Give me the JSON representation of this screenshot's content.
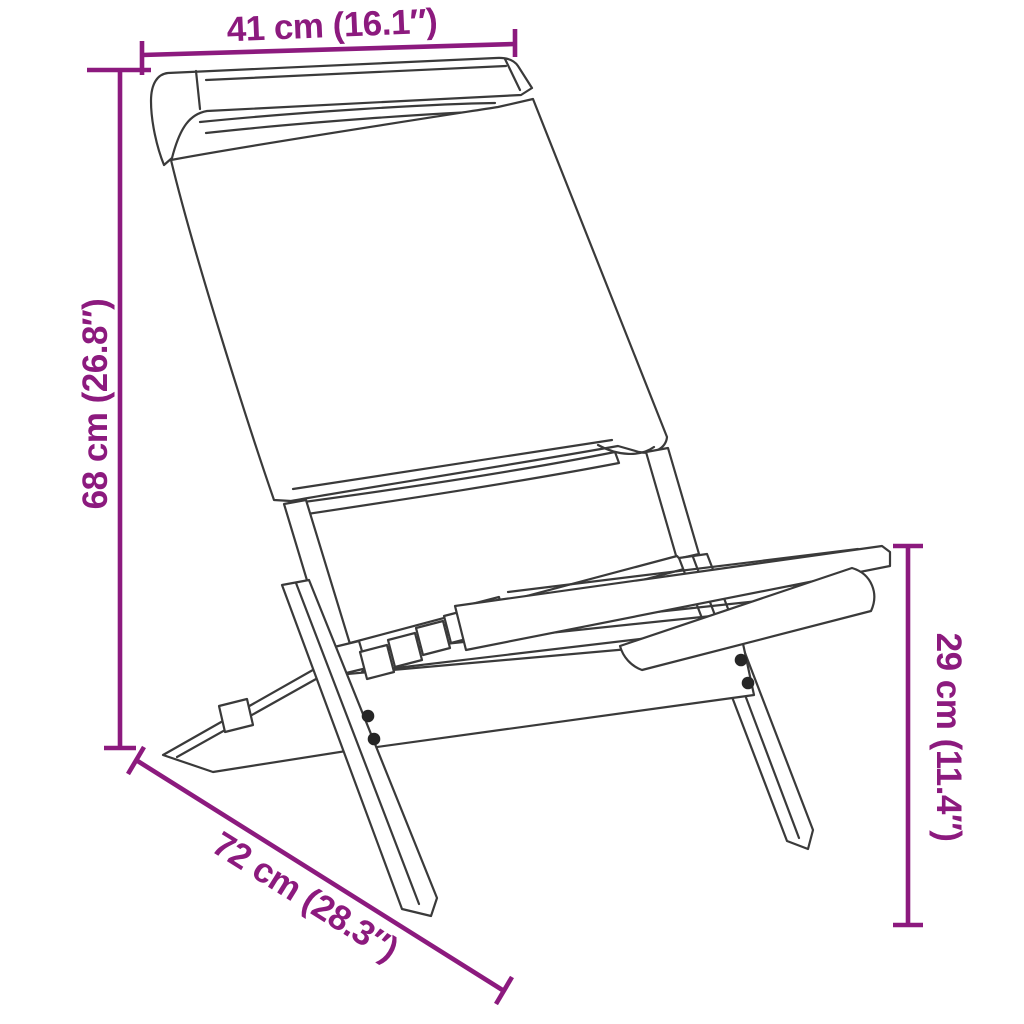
{
  "diagram": {
    "type": "product-dimension-diagram",
    "subject": "folding chair with fabric back and slatted wooden seat (line drawing)",
    "colors": {
      "dimension_accent": "#8C1A7E",
      "line_art": "#3A3A3A",
      "background": "#FFFFFF"
    },
    "measurements": {
      "top": {
        "label": "41 cm (16.1″)",
        "value_cm": 41,
        "value_in": 16.1,
        "position": "top-horizontal"
      },
      "left": {
        "label": "68 cm (26.8″)",
        "value_cm": 68,
        "value_in": 26.8,
        "position": "left-vertical"
      },
      "right": {
        "label": "29 cm (11.4″)",
        "value_cm": 29,
        "value_in": 11.4,
        "position": "right-vertical"
      },
      "bottom": {
        "label": "72 cm (28.3″)",
        "value_cm": 72,
        "value_in": 28.3,
        "position": "bottom-diagonal"
      }
    }
  }
}
